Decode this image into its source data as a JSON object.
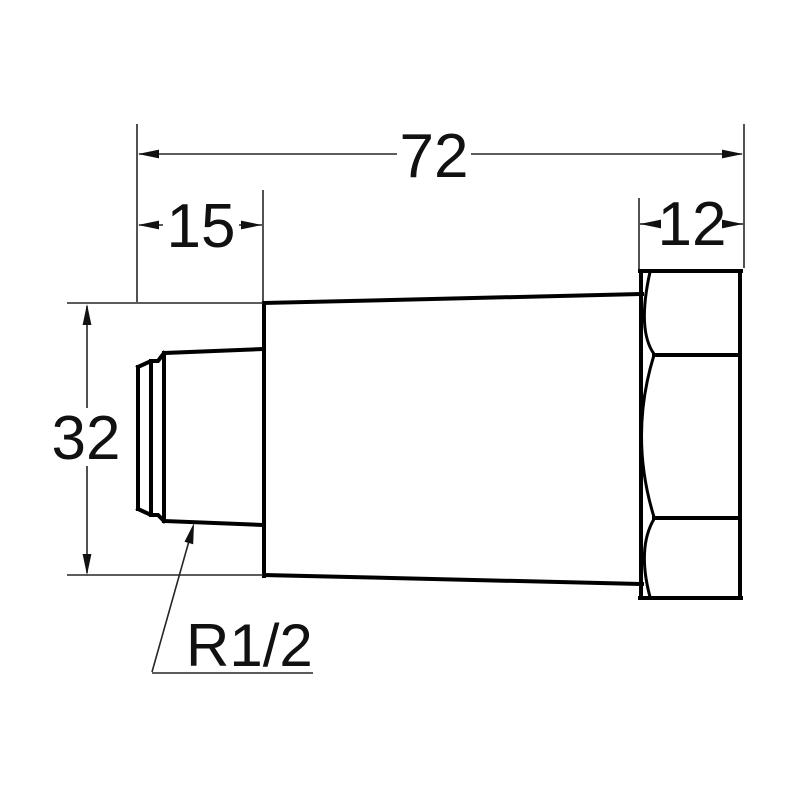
{
  "drawing": {
    "background_color": "#ffffff",
    "line_color": "#000000",
    "labels": {
      "overall_length": "72",
      "thread_length": "15",
      "hex_width": "12",
      "diameter": "32",
      "thread_spec": "R1/2"
    }
  }
}
